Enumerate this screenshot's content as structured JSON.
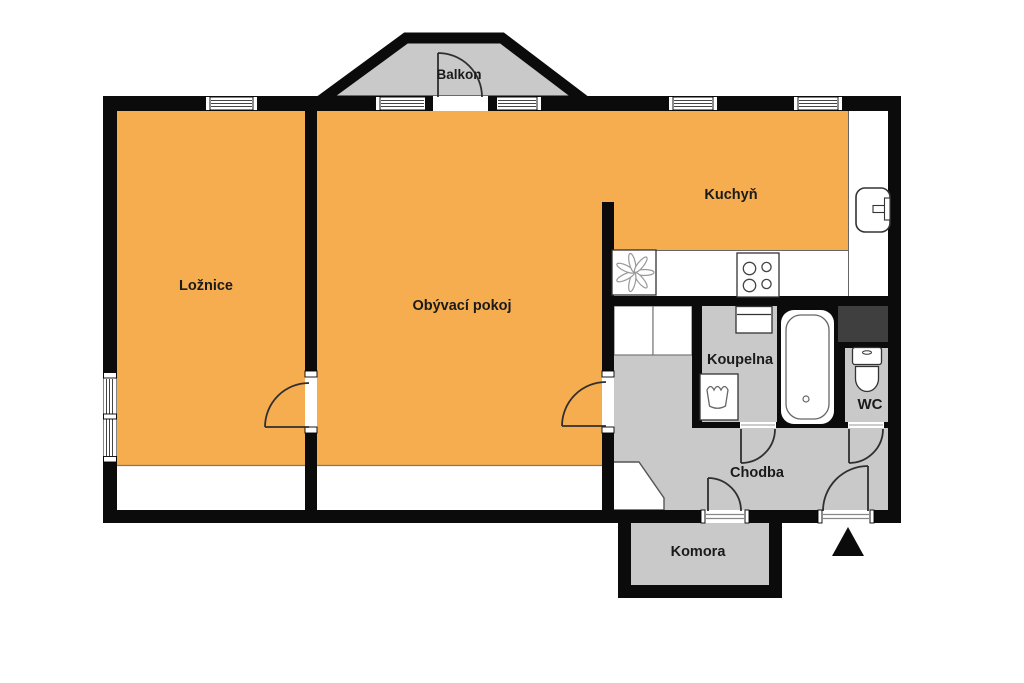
{
  "plan": {
    "type": "floor-plan",
    "rooms": [
      {
        "id": "balkon",
        "label": "Balkon"
      },
      {
        "id": "loznice",
        "label": "Ložnice"
      },
      {
        "id": "obyvaci-pokoj",
        "label": "Obývací pokoj"
      },
      {
        "id": "kuchyn",
        "label": "Kuchyň"
      },
      {
        "id": "koupelna",
        "label": "Koupelna"
      },
      {
        "id": "wc",
        "label": "WC"
      },
      {
        "id": "chodba",
        "label": "Chodba"
      },
      {
        "id": "komora",
        "label": "Komora"
      }
    ],
    "fixtures": [
      "kitchen-sink",
      "cooktop-4-burner",
      "fan-appliance-symbol",
      "washing-machine",
      "washbasin",
      "bathtub",
      "toilet",
      "built-in-wardrobes",
      "installation-shaft",
      "entrance-triangle-marker",
      "balcony-door",
      "entrance-door",
      "storage-door",
      "bathroom-door",
      "wc-door",
      "bedroom-door",
      "living-room-door",
      "windows"
    ],
    "colors": {
      "highlighted_rooms": "#f5ad4f",
      "secondary_areas": "#c9c9c9",
      "walls": "#0b0b0b",
      "shaft": "#3f3f3f",
      "background": "#ffffff"
    }
  }
}
